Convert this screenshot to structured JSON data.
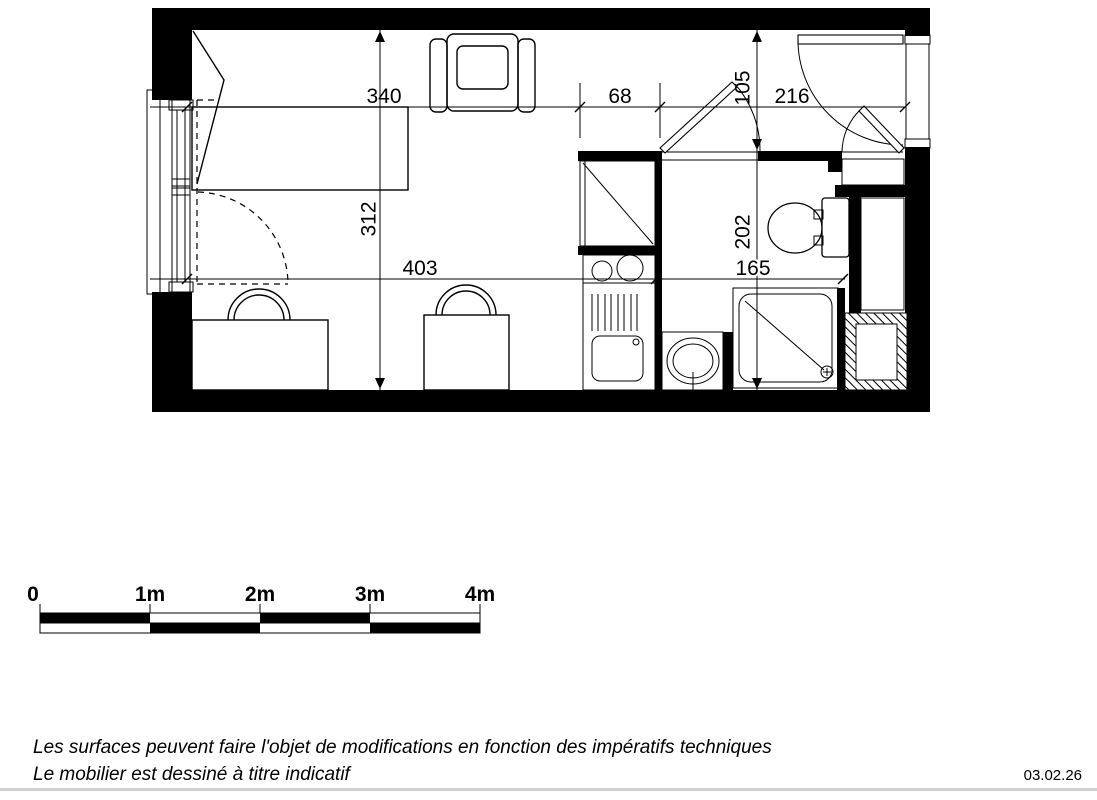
{
  "plan": {
    "dim_340": "340",
    "dim_68": "68",
    "dim_105": "105",
    "dim_216": "216",
    "dim_312": "312",
    "dim_403": "403",
    "dim_202": "202",
    "dim_165": "165"
  },
  "scale_bar": {
    "labels": [
      "0",
      "1m",
      "2m",
      "3m",
      "4m"
    ]
  },
  "footer": {
    "note_line1": "Les surfaces peuvent faire l'objet de modifications en fonction des impératifs techniques",
    "note_line2": "Le mobilier est dessiné à titre indicatif",
    "date": "03.02.26"
  },
  "colors": {
    "ink": "#000000",
    "paper": "#ffffff"
  }
}
